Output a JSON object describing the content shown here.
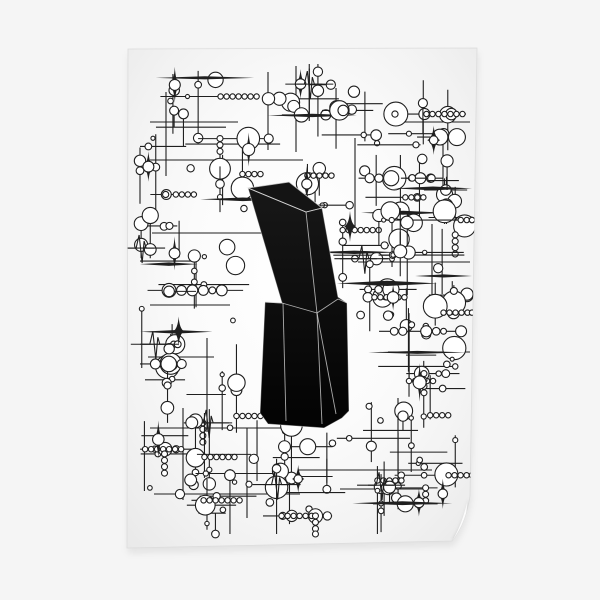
{
  "scene": {
    "canvas": {
      "width": 600,
      "height": 600,
      "background_color": "#f5f5f5"
    },
    "poster": {
      "path": "M128,49 L477,48 L470,496 Q466,523 452,541 L127,548 Z",
      "corners": {
        "top_left": [
          128,
          49
        ],
        "top_right": [
          477,
          48
        ],
        "curl_start": [
          470,
          496
        ],
        "curl_tip": [
          452,
          541
        ],
        "bottom_left": [
          127,
          548
        ]
      },
      "surface": {
        "highlight": "#ffffff",
        "mid": "#fbfbfb",
        "soft": "#f2f2f2",
        "edge_shade": "#e7e7e7",
        "edge_line": "#dcdcdc"
      },
      "shadow": {
        "color": "rgba(0,0,0,0.08)",
        "offset_x": 1,
        "offset_y": 5
      },
      "curl": {
        "shadow_color": "#bdbdbd",
        "face_color": "#fdfdfd"
      }
    },
    "artwork": {
      "ink": "#1f1f1f",
      "stroke_width": 1.1,
      "circle_fill": "#ffffff",
      "seed": 1337,
      "bounds": {
        "x0": 140,
        "y0": 64,
        "x1": 472,
        "y1": 534
      },
      "long_h_lines": [
        [
          150,
          122,
          238
        ],
        [
          390,
          122,
          470
        ],
        [
          150,
          160,
          303
        ],
        [
          152,
          233,
          262
        ],
        [
          358,
          262,
          470
        ],
        [
          150,
          305,
          230
        ],
        [
          148,
          357,
          214
        ],
        [
          388,
          352,
          470
        ],
        [
          150,
          428,
          282
        ],
        [
          298,
          470,
          432
        ],
        [
          154,
          494,
          300
        ],
        [
          340,
          489,
          428
        ]
      ],
      "long_v_lines": [
        [
          268,
          72,
          150
        ],
        [
          296,
          66,
          152
        ],
        [
          166,
          92,
          176
        ],
        [
          355,
          138,
          228
        ],
        [
          432,
          224,
          318
        ],
        [
          207,
          338,
          432
        ],
        [
          247,
          428,
          518
        ],
        [
          398,
          398,
          478
        ],
        [
          443,
          130,
          210
        ],
        [
          183,
          408,
          500
        ]
      ],
      "clusters": [
        [
          195,
          105,
          42
        ],
        [
          300,
          92,
          38
        ],
        [
          355,
          118,
          30
        ],
        [
          432,
          124,
          38
        ],
        [
          165,
          175,
          38
        ],
        [
          232,
          172,
          40
        ],
        [
          310,
          185,
          28
        ],
        [
          395,
          175,
          40
        ],
        [
          445,
          207,
          33
        ],
        [
          158,
          245,
          34
        ],
        [
          200,
          282,
          42
        ],
        [
          365,
          250,
          36
        ],
        [
          425,
          250,
          40
        ],
        [
          390,
          305,
          38
        ],
        [
          453,
          300,
          28
        ],
        [
          162,
          352,
          38
        ],
        [
          205,
          390,
          45
        ],
        [
          420,
          355,
          40
        ],
        [
          440,
          392,
          33
        ],
        [
          175,
          455,
          38
        ],
        [
          235,
          462,
          45
        ],
        [
          300,
          450,
          33
        ],
        [
          380,
          440,
          40
        ],
        [
          425,
          470,
          38
        ],
        [
          210,
          500,
          33
        ],
        [
          300,
          498,
          40
        ],
        [
          395,
          495,
          36
        ]
      ],
      "motif_probs": {
        "chain": 0.45,
        "bead_row": 0.5,
        "bead_col": 0.3,
        "stem": 0.55,
        "sparkle": 0.3,
        "wave": 0.2,
        "taper": 0.3
      }
    },
    "sculpture": {
      "fill_top": "#181818",
      "fill_bottom": "#030303",
      "top_face_fill": "#141414",
      "edge_highlight": "rgba(255,255,255,0.4)",
      "facet_line_color": "rgba(225,225,225,0.75)",
      "silhouette": [
        [
          248,
          188
        ],
        [
          289,
          182
        ],
        [
          322,
          208
        ],
        [
          338,
          297
        ],
        [
          347,
          303
        ],
        [
          349,
          411
        ],
        [
          342,
          418
        ],
        [
          324,
          428
        ],
        [
          268,
          424
        ],
        [
          260,
          413
        ],
        [
          265,
          302
        ],
        [
          282,
          303
        ]
      ],
      "top_face": [
        [
          248,
          188
        ],
        [
          289,
          182
        ],
        [
          322,
          208
        ],
        [
          306,
          212
        ]
      ],
      "facet_lines": [
        [
          [
            248,
            188
          ],
          [
            306,
            212
          ]
        ],
        [
          [
            306,
            212
          ],
          [
            322,
            208
          ]
        ],
        [
          [
            306,
            212
          ],
          [
            317,
            313
          ]
        ],
        [
          [
            282,
            303
          ],
          [
            317,
            313
          ]
        ],
        [
          [
            317,
            313
          ],
          [
            338,
            299
          ]
        ],
        [
          [
            265,
            302
          ],
          [
            282,
            303
          ]
        ],
        [
          [
            283,
            303
          ],
          [
            286,
            421
          ]
        ],
        [
          [
            317,
            313
          ],
          [
            322,
            424
          ]
        ],
        [
          [
            317,
            313
          ],
          [
            336,
            414
          ]
        ],
        [
          [
            338,
            299
          ],
          [
            347,
            303
          ]
        ]
      ]
    }
  }
}
